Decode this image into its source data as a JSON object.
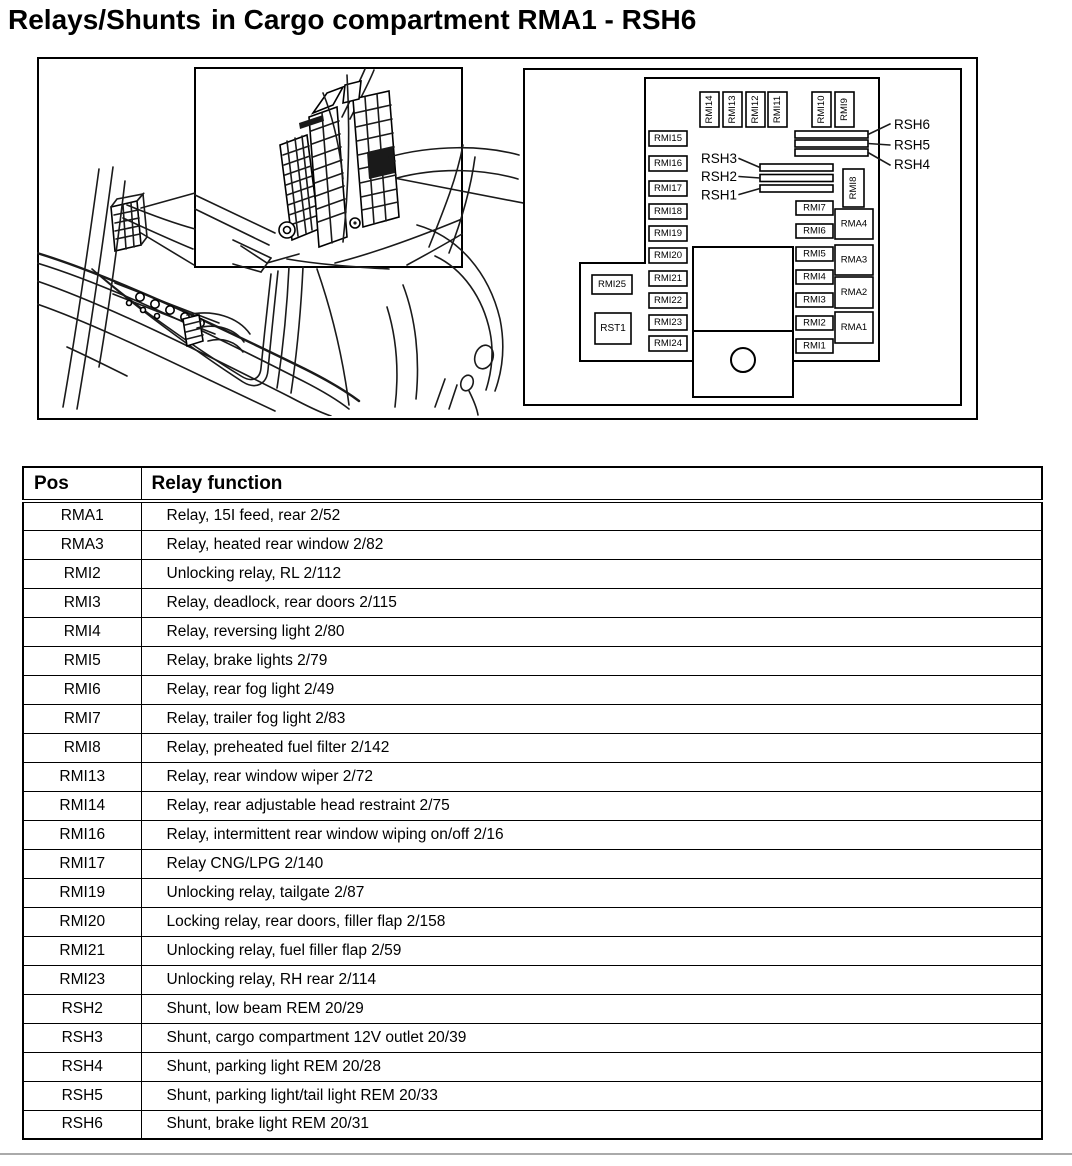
{
  "page": {
    "title_part1": "Relays/Shunts",
    "title_part2": "in Cargo compartment RMA1 - RSH6"
  },
  "schematic": {
    "top_row": [
      "RMI14",
      "RMI13",
      "RMI12",
      "RMI11",
      "RMI10",
      "RMI9"
    ],
    "left_column": [
      "RMI15",
      "RMI16",
      "RMI17",
      "RMI18",
      "RMI19",
      "RMI20",
      "RMI21",
      "RMI22",
      "RMI23",
      "RMI24"
    ],
    "right_column": [
      "RMI7",
      "RMI6",
      "RMI5",
      "RMI4",
      "RMI3",
      "RMI2",
      "RMI1"
    ],
    "rma_column": [
      "RMA4",
      "RMA3",
      "RMA2",
      "RMA1"
    ],
    "rmi8": "RMI8",
    "rmi25": "RMI25",
    "rst1": "RST1",
    "rsh_right": [
      "RSH6",
      "RSH5",
      "RSH4"
    ],
    "rsh_left": [
      "RSH3",
      "RSH2",
      "RSH1"
    ]
  },
  "table": {
    "headers": [
      "Pos",
      "Relay function"
    ],
    "rows": [
      [
        "RMA1",
        "Relay, 15I feed, rear 2/52"
      ],
      [
        "RMA3",
        "Relay, heated rear window 2/82"
      ],
      [
        "RMI2",
        "Unlocking relay, RL 2/112"
      ],
      [
        "RMI3",
        "Relay, deadlock, rear doors 2/115"
      ],
      [
        "RMI4",
        "Relay, reversing light 2/80"
      ],
      [
        "RMI5",
        "Relay, brake lights 2/79"
      ],
      [
        "RMI6",
        "Relay, rear fog light 2/49"
      ],
      [
        "RMI7",
        "Relay, trailer fog light 2/83"
      ],
      [
        "RMI8",
        "Relay, preheated fuel filter 2/142"
      ],
      [
        "RMI13",
        "Relay, rear window wiper 2/72"
      ],
      [
        "RMI14",
        "Relay, rear adjustable head restraint 2/75"
      ],
      [
        "RMI16",
        "Relay, intermittent rear window wiping on/off 2/16"
      ],
      [
        "RMI17",
        "Relay CNG/LPG 2/140"
      ],
      [
        "RMI19",
        "Unlocking relay, tailgate 2/87"
      ],
      [
        "RMI20",
        "Locking relay, rear doors, filler flap 2/158"
      ],
      [
        "RMI21",
        "Unlocking relay, fuel filler flap 2/59"
      ],
      [
        "RMI23",
        "Unlocking relay, RH rear 2/114"
      ],
      [
        "RSH2",
        "Shunt, low beam REM 20/29"
      ],
      [
        "RSH3",
        "Shunt, cargo compartment 12V outlet 20/39"
      ],
      [
        "RSH4",
        "Shunt, parking light REM 20/28"
      ],
      [
        "RSH5",
        "Shunt, parking light/tail light REM 20/33"
      ],
      [
        "RSH6",
        "Shunt, brake light REM 20/31"
      ]
    ]
  }
}
